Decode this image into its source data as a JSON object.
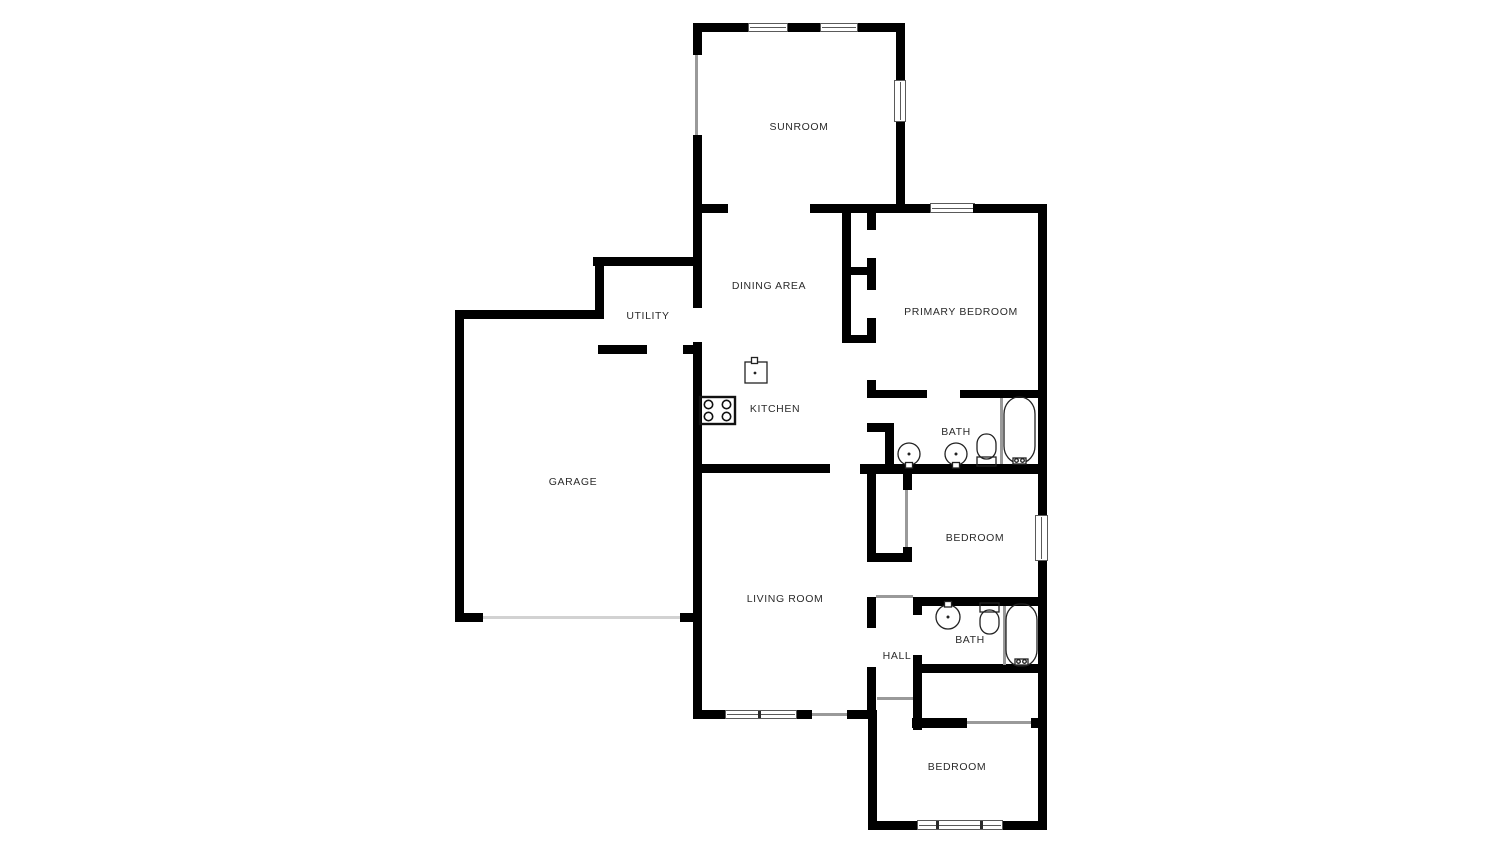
{
  "document": {
    "type": "floor-plan",
    "background_color": "#ffffff",
    "wall_color": "#000000",
    "label_color": "#2b2b2b"
  },
  "rooms": [
    {
      "id": "sunroom",
      "label": "SUNROOM"
    },
    {
      "id": "dining-area",
      "label": "DINING AREA"
    },
    {
      "id": "utility",
      "label": "UTILITY"
    },
    {
      "id": "kitchen",
      "label": "KITCHEN"
    },
    {
      "id": "garage",
      "label": "GARAGE"
    },
    {
      "id": "living-room",
      "label": "LIVING ROOM"
    },
    {
      "id": "primary-bedroom",
      "label": "PRIMARY BEDROOM"
    },
    {
      "id": "bath-1",
      "label": "BATH"
    },
    {
      "id": "bedroom-2",
      "label": "BEDROOM"
    },
    {
      "id": "bath-2",
      "label": "BATH"
    },
    {
      "id": "hall",
      "label": "HALL"
    },
    {
      "id": "bedroom-3",
      "label": "BEDROOM"
    }
  ],
  "fixtures": [
    "stove-cooktop",
    "kitchen-sink",
    "bath1-sink-left",
    "bath1-sink-right",
    "bath1-toilet",
    "bath1-bathtub",
    "bath2-sink",
    "bath2-toilet",
    "bath2-bathtub"
  ],
  "openings": [
    "garage-door",
    "front-door",
    "windows"
  ]
}
